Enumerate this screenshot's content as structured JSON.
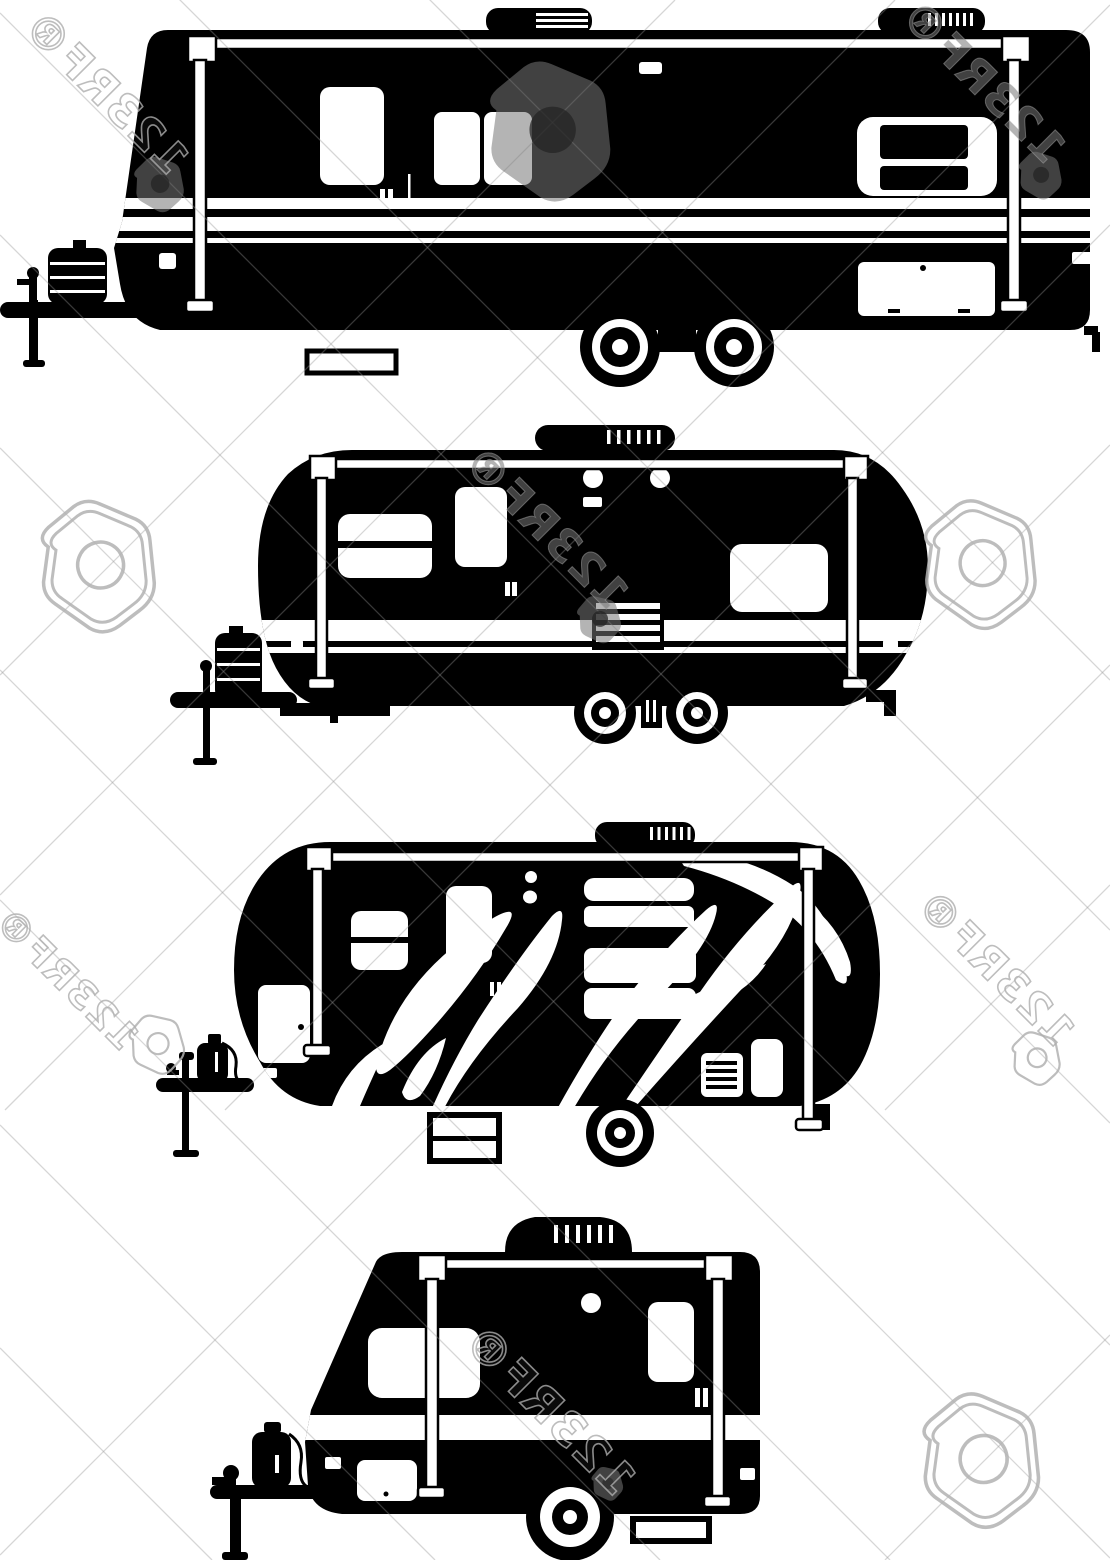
{
  "canvas": {
    "width": 1110,
    "height": 1560,
    "background_color": "#ffffff",
    "silhouette_color": "#000000"
  },
  "watermark": {
    "label": "123RF®",
    "brand": "123RF",
    "registered_symbol": "®",
    "filled_color": "#787878",
    "outline_color": "#b0b0b0",
    "hairline_color": "#949494"
  },
  "items": [
    {
      "id": "trailer-1",
      "name": "large-travel-trailer-silhouette",
      "features": "twin axle, two roof vents, awning poles, propane tanks, tongue jack"
    },
    {
      "id": "trailer-2",
      "name": "rounded-travel-trailer-silhouette",
      "features": "twin axle, capsule body, entry step grille, awning poles"
    },
    {
      "id": "trailer-3",
      "name": "flame-graphics-travel-trailer-silhouette",
      "features": "single axle, flame decals, two-rung step, propane tank"
    },
    {
      "id": "trailer-4",
      "name": "compact-travel-trailer-silhouette",
      "features": "single axle, sloped front, propane tank, rear step"
    }
  ]
}
